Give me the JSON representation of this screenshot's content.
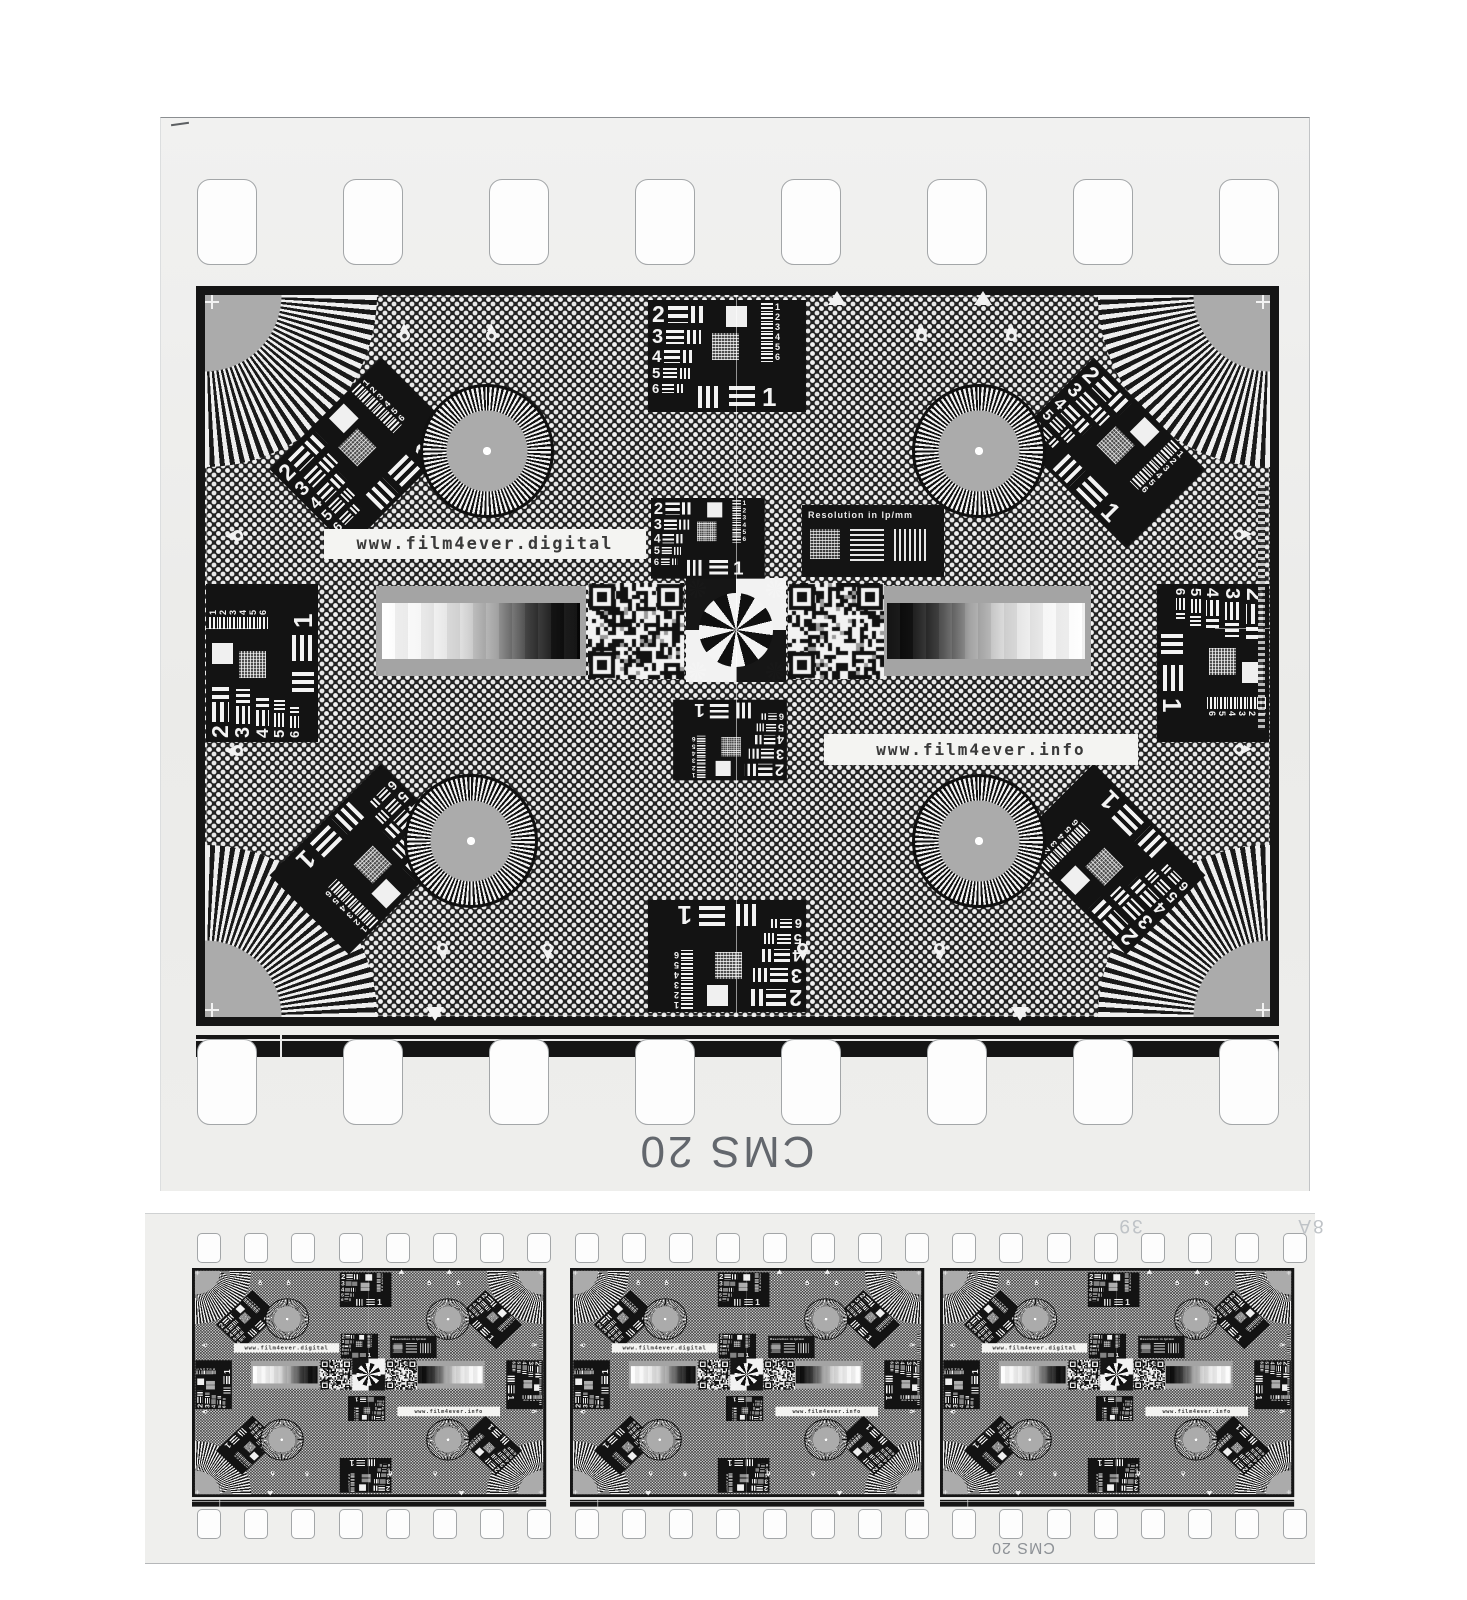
{
  "scan": {
    "film_type_label": "CMS 20",
    "film_type_label_small": "CMS 20",
    "frame_number": "39",
    "frame_edge_code": "8A"
  },
  "chart": {
    "url_digital": "www.film4ever.digital",
    "url_info": "www.film4ever.info",
    "resolution_label": "Resolution in lp/mm",
    "block": {
      "left_numbers": [
        "2",
        "3",
        "4",
        "5",
        "6"
      ],
      "right_numbers": [
        "1",
        "2",
        "3",
        "4",
        "5",
        "6"
      ],
      "big_number": "1"
    },
    "colors": {
      "film_base": "#eeeeec",
      "chart_black": "#151515",
      "pattern_light": "#f2f2f2",
      "mid_gray": "#a9a9a9",
      "label_gray": "#63676d",
      "edge_code_gray": "#bfc3c7"
    }
  }
}
